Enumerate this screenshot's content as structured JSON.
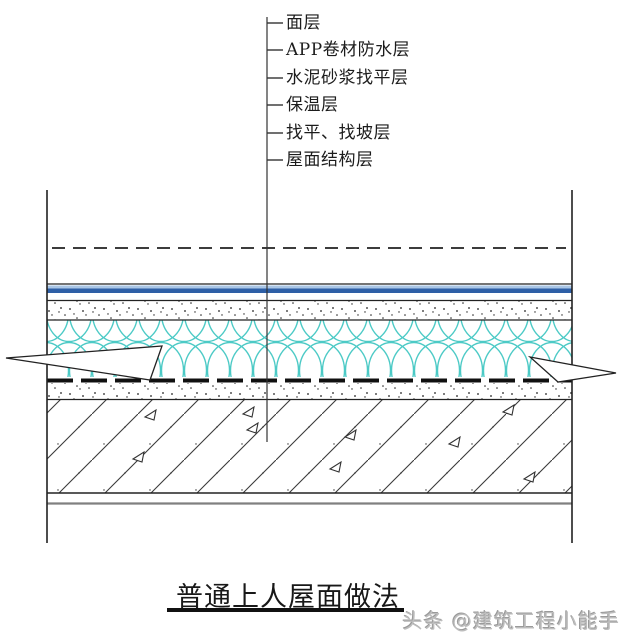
{
  "diagram": {
    "title": "普通上人屋面做法",
    "watermark": "头条 @建筑工程小能手",
    "layer_labels": [
      "面层",
      "APP卷材防水层",
      "水泥砂浆找平层",
      "保温层",
      "找平、找坡层",
      "屋面结构层"
    ],
    "colors": {
      "line": "#222222",
      "waterproof_membrane_dark_blue": "#2e5fa6",
      "waterproof_membrane_light_blue": "#a9c6e6",
      "insulation_teal": "#4ccac6",
      "watermark_gray": "#bdbdbd"
    }
  }
}
